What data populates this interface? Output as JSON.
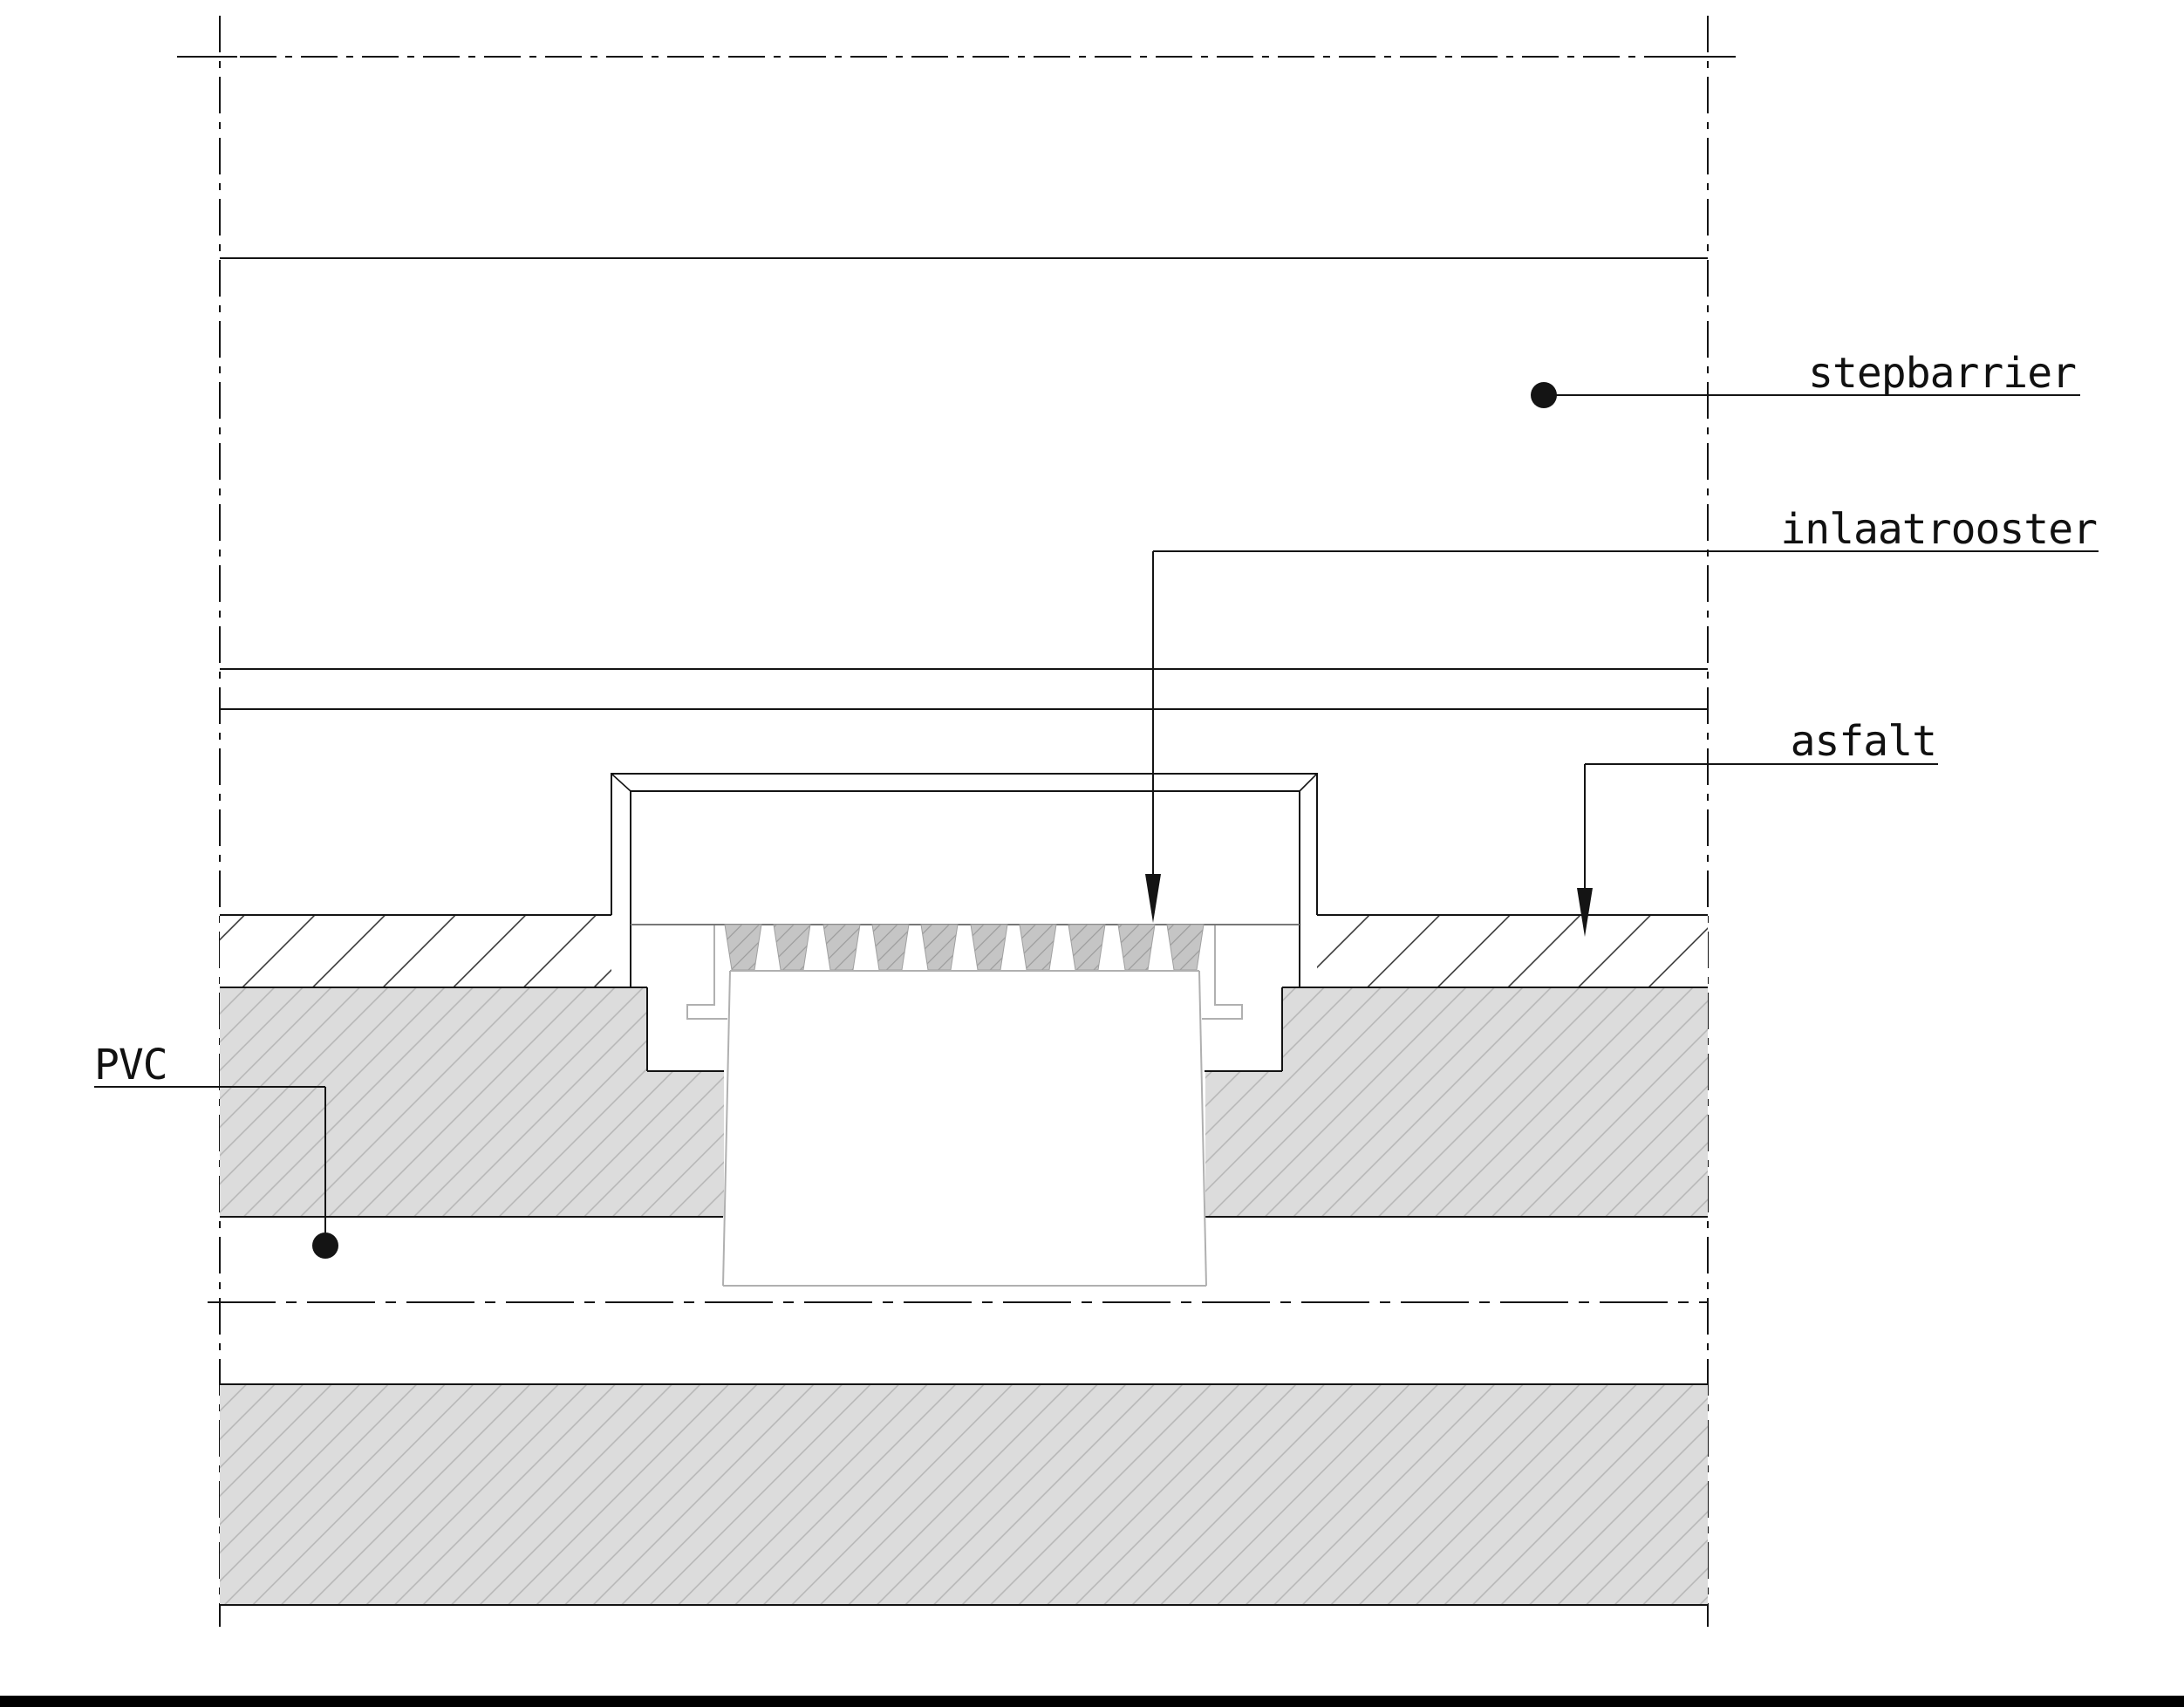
{
  "drawing": {
    "type": "technical-detail-drawing",
    "subject": "road drainage gully cross-section",
    "labels": {
      "stepbarrier": "stepbarrier",
      "inlaatrooster": "inlaatrooster",
      "asfalt": "asfalt",
      "pvc": "PVC"
    },
    "colors": {
      "line_black": "#141414",
      "pot_gray": "#b0b0b0",
      "fill_gray": "#dcdcdc",
      "hatch_gray": "#b5b5b5",
      "teeth_fill": "#c5c5c5",
      "teeth_hatch": "#9b9b9b",
      "background": "#ffffff",
      "bottom_bar": "#000000"
    }
  }
}
